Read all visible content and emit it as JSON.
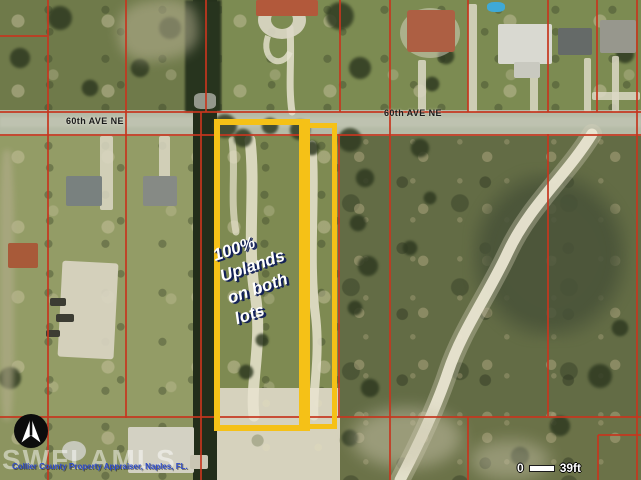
{
  "map": {
    "title": "aerial-parcel-map",
    "street_labels": {
      "left": "60th AVE NE",
      "right": "60th AVE NE"
    },
    "annotation": {
      "text": "100%\nUplands\non both\nlots"
    },
    "watermark": "SWFLAMLS",
    "attribution": "Collier County Property Appraiser, Naples, FL.",
    "scale": {
      "start": "0",
      "end": "39ft"
    },
    "icons": {
      "compass": "north-arrow-icon"
    }
  },
  "colors": {
    "parcel_line": "#c6361f",
    "lot_highlight": "#f5c117",
    "road_label": "#1a1a1a",
    "annotation_text": "#ffffff",
    "annotation_shadow": "#101e56",
    "attribution_text": "#2d4bcb",
    "scale_text": "#ffffff",
    "watermark_text": "#ffffff",
    "road_surface": "#b5bba7",
    "canal": "#222d1a"
  }
}
